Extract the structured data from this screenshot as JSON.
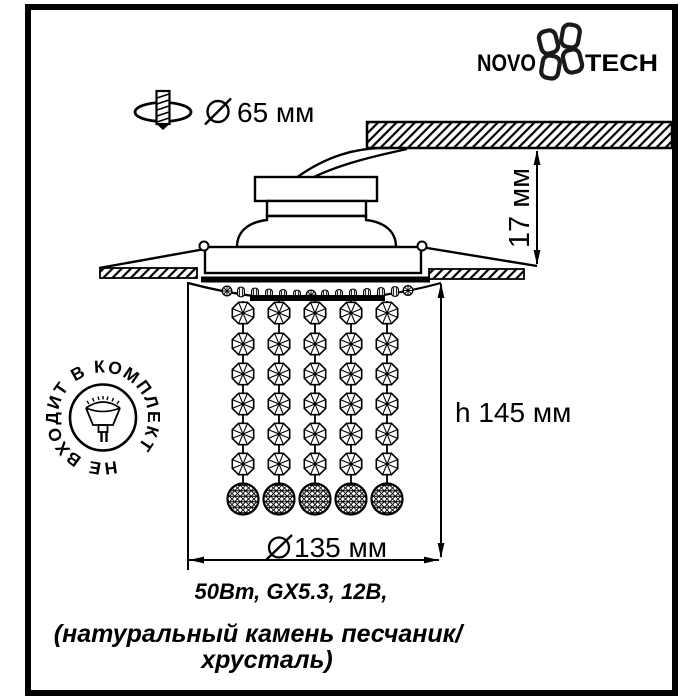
{
  "colors": {
    "background": "#ffffff",
    "line": "#000000",
    "frame": "#000000"
  },
  "brand": {
    "wordmark_left": "NOVO",
    "wordmark_right": "TECH"
  },
  "drill_callout": {
    "label": "65 мм"
  },
  "depth_dimension": {
    "label": "17 мм"
  },
  "height_dimension": {
    "label": "h 145 мм"
  },
  "width_dimension": {
    "label": "135 мм"
  },
  "stamp": {
    "text": "НЕ ВХОДИТ В КОМПЛЕКТ"
  },
  "specs": {
    "line1": "50Вт, GX5.3, 12В,",
    "line2": "(натуральный камень песчаник/",
    "line3": "хрусталь)"
  },
  "icons": {
    "flower-icon": "four-petal Novotech logo mark",
    "drill-icon": "drill bit in mounting hole",
    "diameter-icon": "circle with slash (diameter sign)",
    "lamp-icon": "GX5.3 halogen lamp (not included)",
    "crystal-octagon-icon": "faceted octagon crystal",
    "crystal-ball-icon": "faceted crystal ball",
    "hatch-icon": "ceiling section hatching"
  }
}
